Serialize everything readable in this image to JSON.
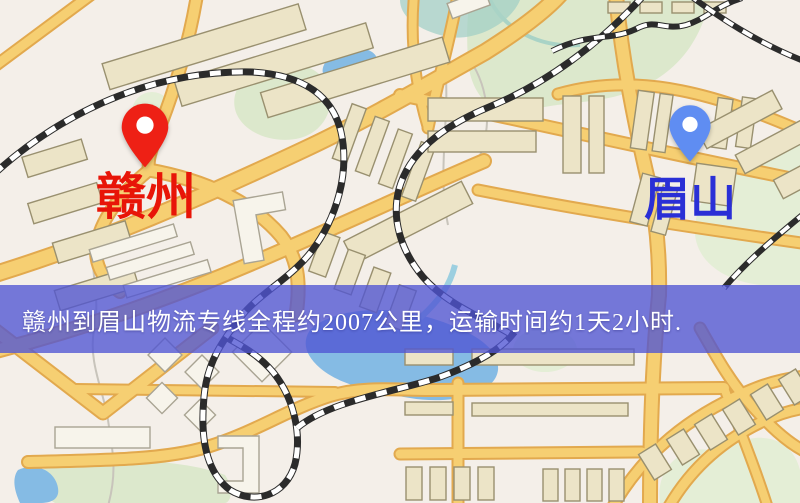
{
  "map": {
    "origin": {
      "label": "赣州",
      "pin_icon": "map-pin",
      "pin_color": "#ee2015",
      "label_color": "#e81508"
    },
    "destination": {
      "label": "眉山",
      "pin_icon": "map-pin",
      "pin_color": "#5f8df2",
      "label_color": "#2a2fd6"
    }
  },
  "banner": {
    "text": "赣州到眉山物流专线全程约2007公里，运输时间约1天2小时.",
    "background_color": "#5055d4",
    "text_color": "#ffffff"
  },
  "palette": {
    "map_background": "#f4efe9",
    "road_fill": "#f6cf72",
    "road_casing": "#e2a94e",
    "park_green": "#dce8cc",
    "water_blue": "#85bbe4",
    "building_fill": "#ece4c7",
    "building_stroke": "#99906f",
    "railway_color": "#2b2b2b"
  }
}
